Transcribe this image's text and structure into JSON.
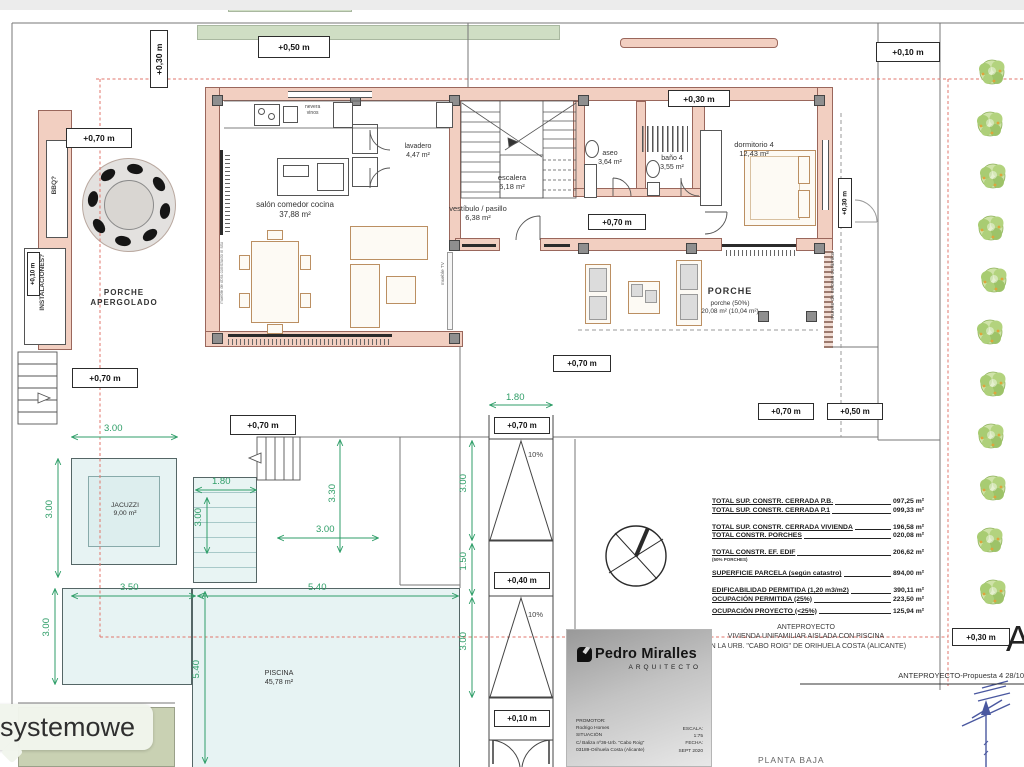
{
  "levels": [
    "+0,30 m",
    "+0,50 m",
    "+0,10 m",
    "+0,70 m",
    "+0,30 m",
    "+0,10 m",
    "+0,70 m",
    "+0,30 m",
    "+0,70 m",
    "+0,70 m",
    "+0,50 m",
    "+0,70 m",
    "+0,70 m",
    "+0,70 m",
    "+0,40 m",
    "+0,10 m",
    "+0,30 m"
  ],
  "dims": [
    "3.00",
    "1.80",
    "3.00",
    "3.30",
    "3.00",
    "3.50",
    "5.40",
    "3.00",
    "3.00",
    "5.40",
    "1.80",
    "3.00",
    "1.50",
    "3.00"
  ],
  "slopes": [
    "10%",
    "10%"
  ],
  "rooms": {
    "salon": {
      "name": "salón comedor cocina",
      "area": "37,88 m²"
    },
    "lavadero": {
      "name": "lavadero",
      "area": "4,47 m²"
    },
    "escalera": {
      "name": "escalera",
      "area": "6,18 m²"
    },
    "vestibulo": {
      "name": "vestíbulo / pasillo",
      "area": "6,38 m²"
    },
    "aseo": {
      "name": "aseo",
      "area": "3,64 m²"
    },
    "bano4": {
      "name": "baño 4",
      "area": "3,55 m²"
    },
    "dormitorio4": {
      "name": "dormitorio 4",
      "area": "12,43 m²"
    },
    "porche": {
      "name": "PORCHE",
      "pct": "porche (50%)",
      "area": "20,08 m² (10,04 m²)"
    },
    "porche_apergolado": {
      "line1": "PORCHE",
      "line2": "APERGOLADO"
    },
    "jacuzzi": {
      "name": "JACUZZI",
      "area": "9,00 m²"
    },
    "piscina": {
      "name": "PISCINA",
      "area": "45,78 m²"
    }
  },
  "notes": {
    "bbq": "BBQ?",
    "instalaciones": "INSTALACIONES?",
    "nevera1": "nevera",
    "nevera2": "vinos",
    "mueble_tv": "mueble TV",
    "mueble_obra": "mueble de obra construido in situ",
    "murete": "murete de celosía cerámica"
  },
  "summary": {
    "rows": [
      {
        "label": "TOTAL SUP. CONSTR. CERRADA P.B.",
        "value": "097,25 m²"
      },
      {
        "label": "TOTAL SUP. CONSTR. CERRADA P.1",
        "value": "099,33 m²"
      },
      {
        "label": "TOTAL SUP. CONSTR. CERRADA VIVIENDA",
        "value": "196,58 m²"
      },
      {
        "label": "TOTAL  CONSTR. PORCHES",
        "value": "020,08 m²"
      },
      {
        "label": "TOTAL  CONSTR.  EF. EDIF",
        "sub": "(50% PORCHES)",
        "value": "206,62 m²"
      },
      {
        "label": "SUPERFICIE PARCELA (según catastro)",
        "value": "894,00 m²"
      },
      {
        "label": "EDIFICABILIDAD PERMITIDA (1,20 m3/m2)",
        "value": "390,11 m²"
      },
      {
        "label": "OCUPACIÓN PERMITIDA (25%)",
        "value": "223,50 m²"
      },
      {
        "label": "OCUPACIÓN PROYECTO (<25%)",
        "value": "125,94 m²"
      }
    ]
  },
  "project": {
    "type": "ANTEPROYECTO",
    "title": "VIVIENDA UNIFAMILIAR AISLADA CON PISCINA",
    "location": "EN LA URB. \"CABO ROIG\" DE ORIHUELA COSTA (ALICANTE)",
    "proposal": "ANTEPROYECTO-Propuesta 4 28/10",
    "plan_name": "PLANTA BAJA",
    "corner_letter": "A"
  },
  "title_block": {
    "studio": "Pedro Miralles",
    "role": "ARQUITECTO",
    "promotor_label": "PROMOTOR:",
    "promotor": "Rodrigo Homes",
    "situacion_label": "SITUACIÓN",
    "situacion1": "C/ Baliza nº36-Urb. \"Cabo Roig\"",
    "situacion2": "03189-Orihuela Costa (Alicante)",
    "escala_label": "ESCALA:",
    "escala": "1:75",
    "fecha_label": "FECHA:",
    "fecha": "SEPT 2020"
  },
  "caption": "systemowe"
}
